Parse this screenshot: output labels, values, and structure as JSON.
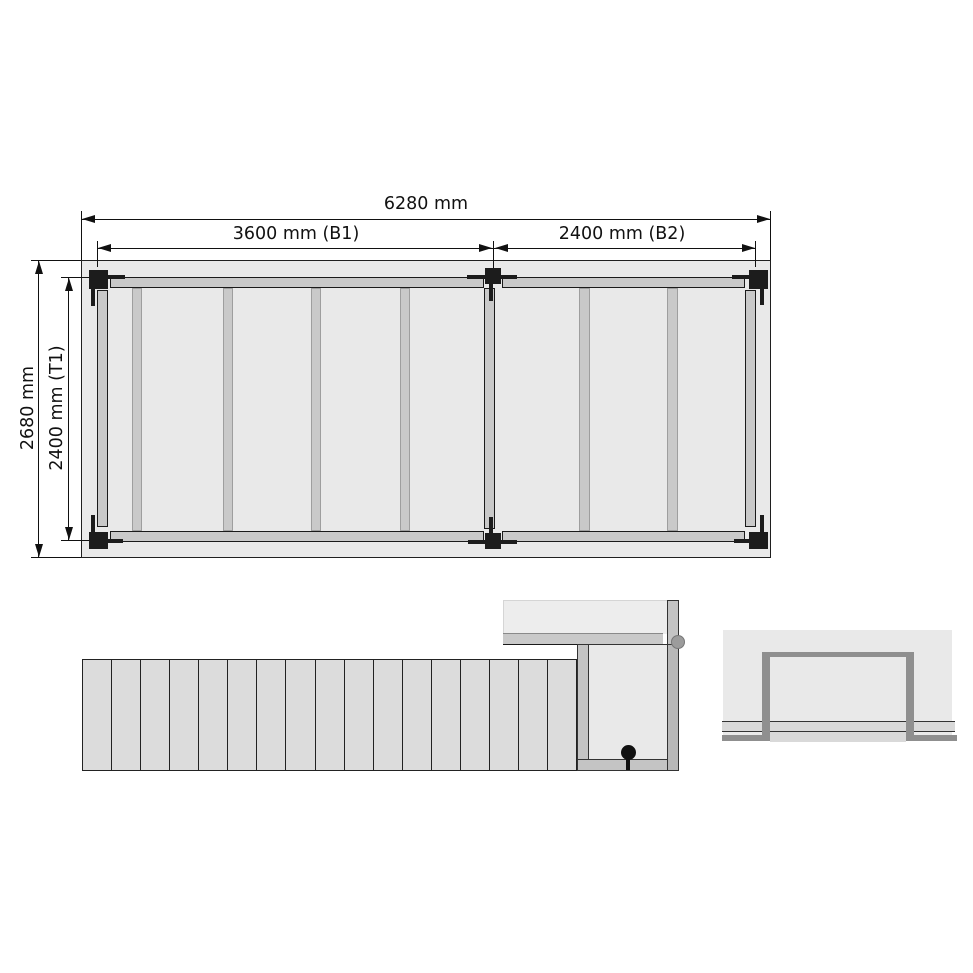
{
  "drawing": {
    "title": "deck-substructure-technical-drawing",
    "views": {
      "plan": {
        "overall_width_label": "6280 mm",
        "bay1_label": "3600 mm (B1)",
        "bay2_label": "2400 mm (B2)",
        "overall_depth_label": "2680 mm",
        "inner_depth_label": "2400 mm (T1)",
        "post_count": 6,
        "bay1_joist_count": 4,
        "bay2_joist_count": 2
      },
      "elevation": {
        "plank_count": 17
      },
      "section_detail": {
        "frame_shape": "inverted-u-frame",
        "fastener_markers": 2
      }
    },
    "colors": {
      "panel_fill": "#e9e9e9",
      "beam_fill": "#c9c9c9",
      "plank_fill": "#dcdcdc",
      "post_fill": "#1c1c1c",
      "frame_gray": "#8f8f8f",
      "outline": "#1a1a1a"
    }
  }
}
